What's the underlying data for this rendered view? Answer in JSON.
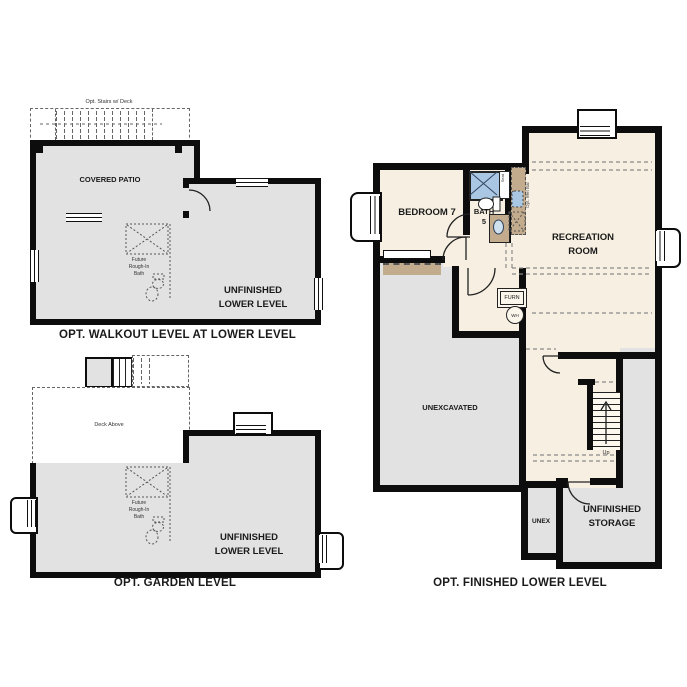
{
  "sheet": {
    "type": "floorplan-options-sheet"
  },
  "colors": {
    "wall": "#0d0d0d",
    "unfinished_gray": "#e2e2e2",
    "finished_cream": "#f7f0e2",
    "cabinet_tan": "#c3ab8d",
    "shower_blue": "#a9c6e2",
    "dashed_line": "#666666",
    "text": "#1a1a1a"
  },
  "icons": {
    "shower": "blue square with X",
    "toilet": "ellipse with tank rect",
    "sink": "oval in vanity",
    "stairs": "parallel tread lines with up arrow",
    "door": "quarter-circle swing arc",
    "window": "triple parallel lines in wall"
  },
  "plans": {
    "walkout": {
      "title": "OPT. WALKOUT LEVEL AT LOWER LEVEL",
      "deck_note": "Opt. Stairs w/ Deck",
      "covered_patio": "COVERED PATIO",
      "unfinished_lower_level": [
        "UNFINISHED",
        "LOWER LEVEL"
      ],
      "future_bath_note": [
        "Future",
        "Rough-In",
        "Bath"
      ]
    },
    "garden": {
      "title": "OPT. GARDEN LEVEL",
      "deck_note": "Deck Above",
      "unfinished_lower_level": [
        "UNFINISHED",
        "LOWER LEVEL"
      ],
      "future_bath_note": [
        "Future",
        "Rough-In",
        "Bath"
      ]
    },
    "finished": {
      "title": "OPT. FINISHED LOWER LEVEL",
      "bedroom": "BEDROOM 7",
      "bath": [
        "BATH",
        "5"
      ],
      "recreation_room": [
        "RECREATION",
        "ROOM"
      ],
      "unexcavated": "UNEXCAVATED",
      "unex": "UNEX",
      "unfinished_storage": [
        "UNFINISHED",
        "STORAGE"
      ],
      "furnace": "FURN",
      "water_heater": "WH",
      "shower_seat": "Seat",
      "wet_bar_note": "Opt. Wet Bar",
      "stairs_up": "Up"
    }
  }
}
